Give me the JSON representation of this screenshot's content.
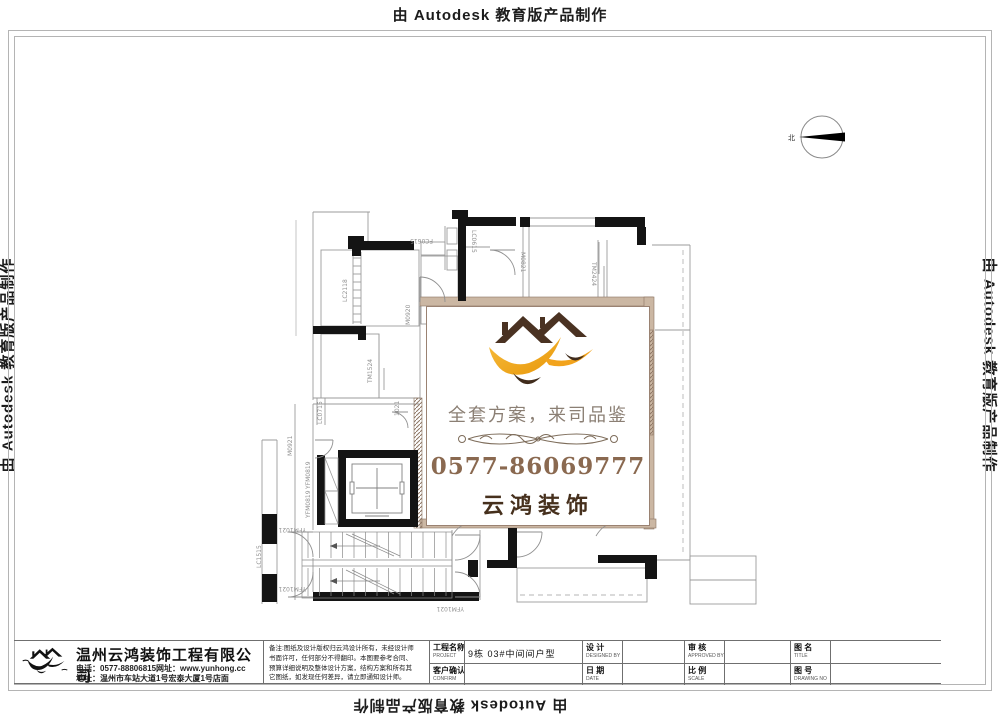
{
  "edge_watermarks": {
    "top": "由 Autodesk 教育版产品制作",
    "left": "由 Autodesk 教育版产品制作",
    "right": "由 Autodesk 教育版产品制作",
    "bottom": "由 Autodesk 教育版产品制作"
  },
  "compass": {
    "label": "北"
  },
  "floor_plan": {
    "labels": [
      {
        "t": "FC0615",
        "x": 433,
        "y": 239,
        "r": 180
      },
      {
        "t": "LC0615",
        "x": 472,
        "y": 230,
        "r": 90
      },
      {
        "t": "M0821",
        "x": 521,
        "y": 252,
        "r": 90
      },
      {
        "t": "TM2424",
        "x": 592,
        "y": 262,
        "r": 90
      },
      {
        "t": "LC2118",
        "x": 347,
        "y": 302,
        "r": -90
      },
      {
        "t": "M0920",
        "x": 410,
        "y": 325,
        "r": -90
      },
      {
        "t": "TM1524",
        "x": 372,
        "y": 383,
        "r": -90
      },
      {
        "t": "LC0715",
        "x": 322,
        "y": 424,
        "r": -90
      },
      {
        "t": "1021",
        "x": 399,
        "y": 416,
        "r": -90
      },
      {
        "t": "M0921",
        "x": 292,
        "y": 456,
        "r": -90
      },
      {
        "t": "YFM0819",
        "x": 310,
        "y": 489,
        "r": -90
      },
      {
        "t": "YFM0819",
        "x": 310,
        "y": 518,
        "r": -90
      },
      {
        "t": "YFM1021",
        "x": 306,
        "y": 528,
        "r": 180
      },
      {
        "t": "LC1515",
        "x": 261,
        "y": 568,
        "r": -90
      },
      {
        "t": "YFM1021",
        "x": 306,
        "y": 587,
        "r": 180
      },
      {
        "t": "YFM1021",
        "x": 464,
        "y": 607,
        "r": 180
      }
    ]
  },
  "center_card": {
    "slogan": "全套方案，来司品鉴",
    "phone": "0577-86069777",
    "brand": "云鸿装饰",
    "colors": {
      "roof": "#4a3222",
      "swoosh": "#f2a31c",
      "swoosh_light": "#f7bd3f",
      "dark_bird": "#402c1c",
      "border": "#9a8272"
    }
  },
  "title_block": {
    "company": {
      "name": "温州云鸿装饰工程有限公司",
      "phone": "电话：0577-88806815网址：www.yunhong.cc",
      "address": "地址：温州市车站大道1号宏泰大厦1号店面"
    },
    "notes": [
      "备注:图纸及设计版权归云鸿设计所有，未经设计师",
      "书面许可，任何部分不得翻印。本图要参考合同、",
      "预算详细说明及整体设计方案，结构方案和所有其",
      "它图纸，如发现任何差异，请立即通知设计师。"
    ],
    "fields": {
      "project_label": "工程名称",
      "project_sub": "PROJECT",
      "project_value": "9栋  03#中间间户型",
      "confirm_label": "客户确认",
      "confirm_sub": "CONFIRM",
      "confirm_value": "",
      "design_label": "设 计",
      "design_sub": "DESIGNED BY",
      "design_value": "",
      "date_label": "日 期",
      "date_sub": "DATE",
      "date_value": "",
      "approve_label": "审 核",
      "approve_sub": "APPROVED BY",
      "approve_value": "",
      "scale_label": "比 例",
      "scale_sub": "SCALE",
      "scale_value": "",
      "title_label": "图 名",
      "title_sub": "TITLE",
      "title_value": "",
      "no_label": "图 号",
      "no_sub": "DRAWING NO",
      "no_value": ""
    }
  }
}
